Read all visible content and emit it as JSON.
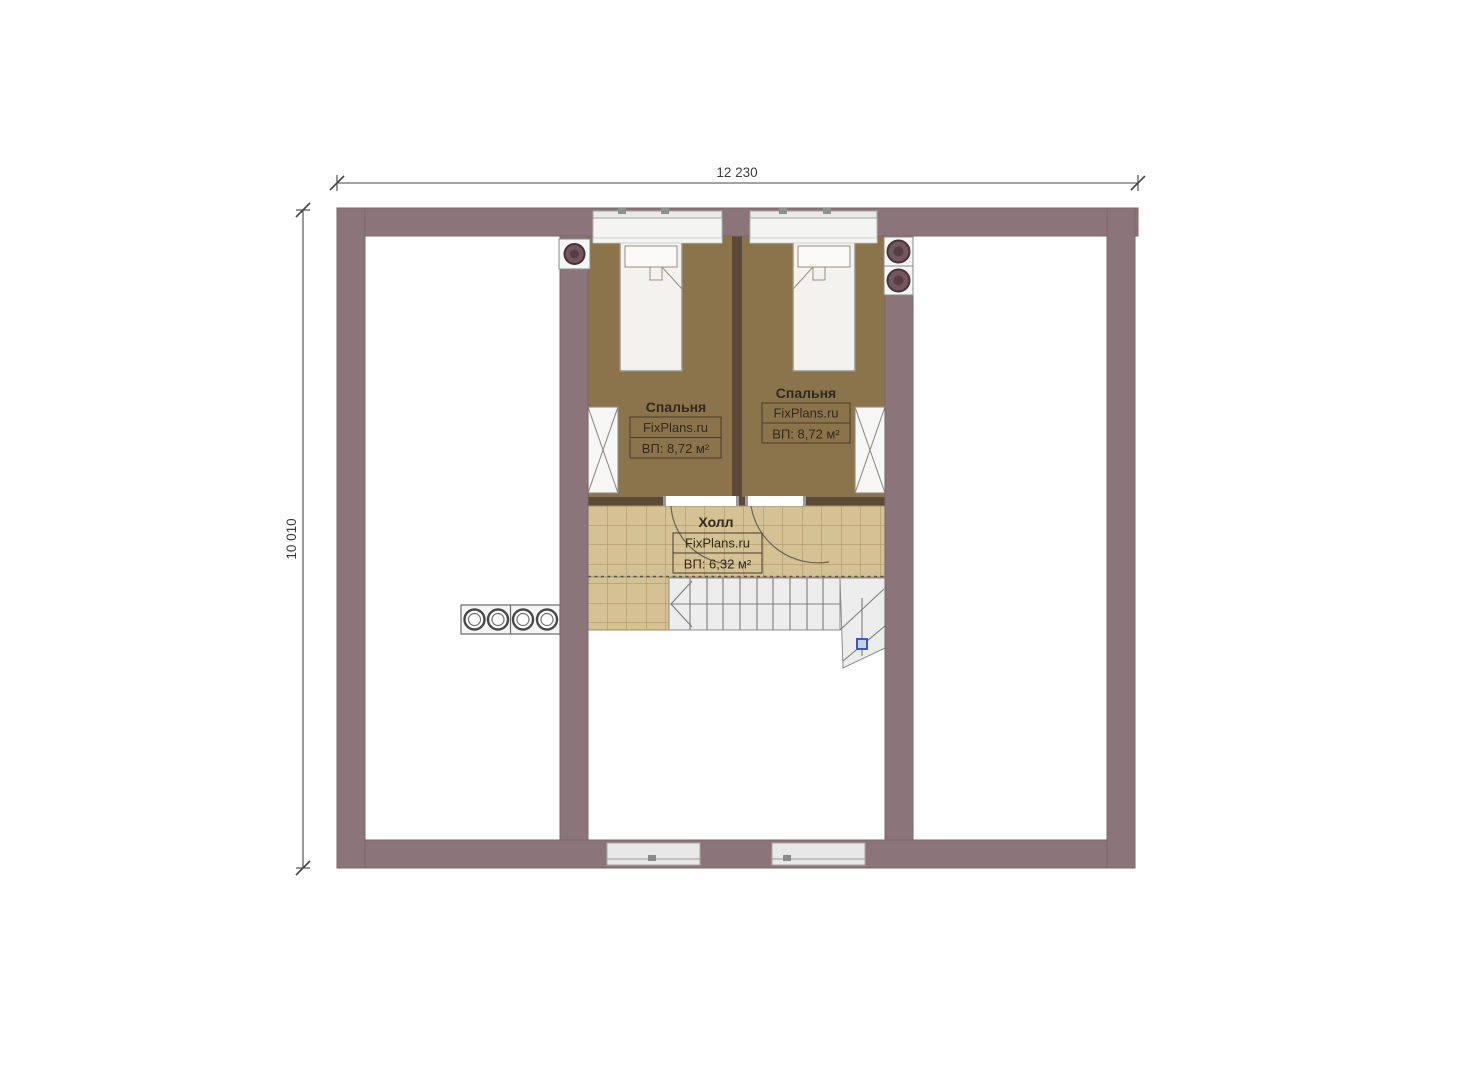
{
  "plan": {
    "dimensions": {
      "width_total": "12 230",
      "height_total": "10 010"
    },
    "rooms": {
      "bedroom_left": {
        "title": "Спальня",
        "brand": "FixPlans.ru",
        "area": "ВП: 8,72 м²"
      },
      "bedroom_right": {
        "title": "Спальня",
        "brand": "FixPlans.ru",
        "area": "ВП: 8,72 м²"
      },
      "hall": {
        "title": "Холл",
        "brand": "FixPlans.ru",
        "area": "ВП: 6,32 м²"
      }
    },
    "colors": {
      "wall": "#8b757a",
      "wall_edge": "#7b666b",
      "partition": "#5d4937",
      "bedroom_floor": "#8b744c",
      "tile_fill": "#d4c194",
      "tile_line": "#a78e5f",
      "stair_fill": "#ededed",
      "stair_line": "#8c8c8c",
      "marker_blue": "#3a57d0",
      "dimension_line": "#444444",
      "label_text": "#33291c"
    }
  }
}
